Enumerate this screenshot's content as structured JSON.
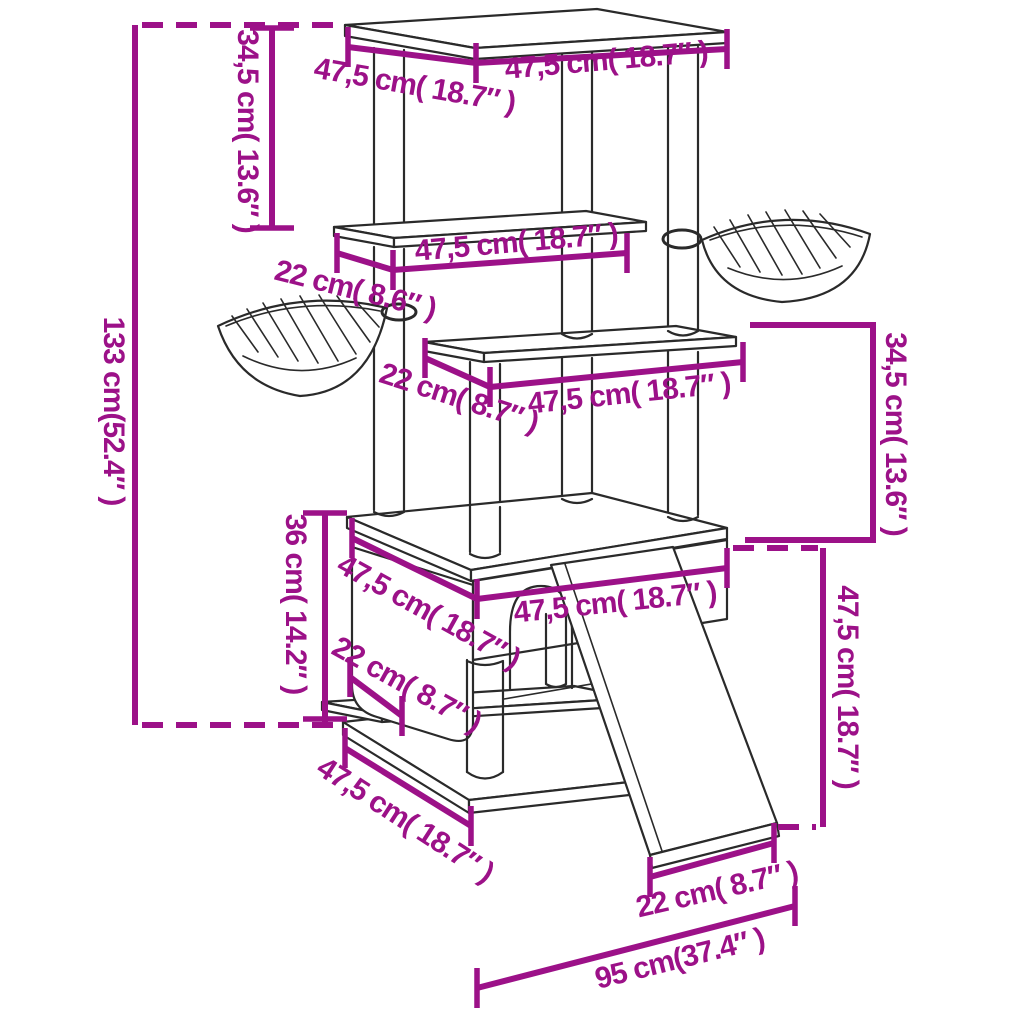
{
  "colors": {
    "accent": "#9c1188",
    "ink": "#2a2a2a",
    "background": "#ffffff"
  },
  "diagram": {
    "type": "product-dimension-diagram",
    "subject": "cat-tree-with-scratching-posts",
    "labels": {
      "total_height": "133 cm(52.4″ )",
      "top_depth": "47,5 cm( 18.7″ )",
      "top_width": "47,5 cm( 18.7″ )",
      "upper_gap_left": "34,5 cm( 13.6″ )",
      "shelf2_depth": "22 cm( 8.6″ )",
      "shelf2_width": "47,5 cm( 18.7″ )",
      "shelf3_depth": "22 cm( 8.7″ )",
      "shelf3_width": "47,5 cm( 18.7″ )",
      "gap_right": "34,5 cm( 13.6″ )",
      "house_width": "47,5 cm( 18.7″ )",
      "house_depth": "47,5 cm( 18.7″ )",
      "house_height": "36 cm( 14.2″ )",
      "house_lower_depth": "22 cm( 8.7″ )",
      "base_depth": "47,5 cm( 18.7″ )",
      "right_height": "47,5 cm( 18.7″ )",
      "ramp_width": "22 cm( 8.7″ )",
      "footprint_width": "95 cm(37.4″ )"
    }
  }
}
